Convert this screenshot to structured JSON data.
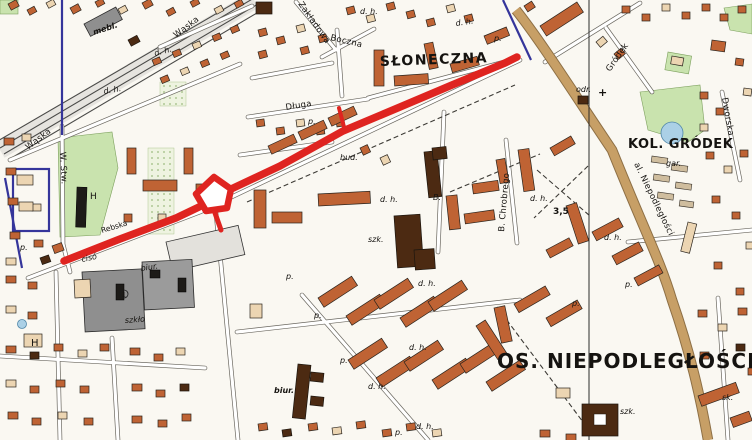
{
  "map": {
    "areas": {
      "sloneczna": "SŁONECZNA",
      "kol_grodek": "KOL. GRÓDEK",
      "os_niepodleglosci": "OS. NIEPODLEGŁOŚCI"
    },
    "streets": {
      "waska": "Wąska",
      "dluga": "Długa",
      "boczna": "Boczna",
      "zakladowa": "Zakładowa",
      "grodek": "Gródek",
      "dworska": "Dworska",
      "al_niepodleglosci": "al. Niepodległości",
      "b_chrobrego": "B. Chrobrego",
      "w_stw": "W. Stw.",
      "rebska": "Rebska",
      "ciso": "cisó"
    },
    "abbr": {
      "dh": "d. h.",
      "p": "p.",
      "szk": "szk.",
      "bud": "bud.",
      "biur": "biur.",
      "szklo": "szkło",
      "gar": "gar.",
      "mebl": "mebl.",
      "odr": "odr.",
      "sk": "sk.",
      "h": "H",
      "b_dot": "B.",
      "num": "3,5",
      "one": "1",
      "cross": "+"
    },
    "colors": {
      "route": "#df2420",
      "navy": "#35359b",
      "road": "#c79f66",
      "park": "#c9e3ae",
      "water": "#abd0e6",
      "building": "#bf6334",
      "public": "#4c2a12",
      "industry": "#8f8f8f",
      "paper": "#faf8f2"
    }
  }
}
